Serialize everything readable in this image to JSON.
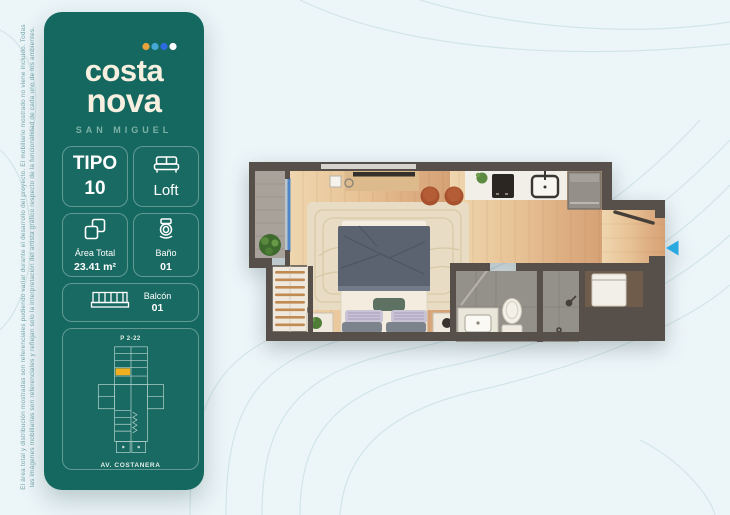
{
  "disclaimer": {
    "line1": "El área total y distribución mostradas son referenciales pudiendo variar durante el desarrollo del proyecto. El mobiliario mostrado no viene incluido. Todas",
    "line2": "las imágenes mobiliarias son referenciales y reflejan solo la interpretación del artista gráfico respecto de la funcionalidad de cada uno de los ambientes."
  },
  "sidebar": {
    "bg_color": "#15685f",
    "logo": {
      "line1": "costa",
      "line2": "nova",
      "subtitle": "SAN MIGUEL",
      "dot_colors": [
        "#E8A33D",
        "#45A7D6",
        "#2B6BE0",
        "#FFFFFF"
      ]
    },
    "cards": {
      "tipo": {
        "label": "TIPO",
        "value": "10"
      },
      "loft": {
        "label": "Loft",
        "icon": "bed-icon"
      },
      "area": {
        "label": "Área Total",
        "value": "23.41 m²",
        "icon": "floorplan-icon"
      },
      "bano": {
        "label": "Baño",
        "value": "01",
        "icon": "toilet-icon"
      },
      "balcon": {
        "label": "Balcón",
        "value": "01",
        "icon": "railing-icon"
      }
    },
    "keyplan": {
      "unit": "P 2-22",
      "street": "AV. COSTANERA",
      "highlight_color": "#F2B01E"
    }
  },
  "floorplan": {
    "arrow_color": "#2AA9E0",
    "wall_color": "#57504a"
  }
}
